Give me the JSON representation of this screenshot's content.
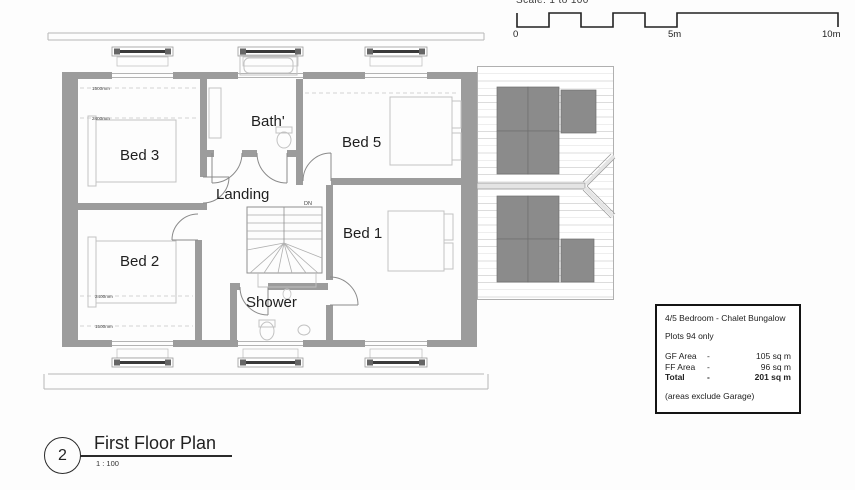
{
  "scale_bar": {
    "caption": "Scale: 1 to 100",
    "ticks": [
      "0",
      "5m",
      "10m"
    ]
  },
  "floor_plan": {
    "rooms": {
      "bed3": "Bed 3",
      "bath": "Bath'",
      "bed5": "Bed 5",
      "landing": "Landing",
      "bed1": "Bed 1",
      "bed2": "Bed 2",
      "shower": "Shower"
    },
    "stair_direction": "DN",
    "dims": {
      "h1500": "1500mm",
      "h2400": "2400mm"
    }
  },
  "info_box": {
    "title": "4/5 Bedroom - Chalet Bungalow",
    "plots": "Plots 94 only",
    "areas": [
      {
        "label": "GF Area",
        "dash": "-",
        "value": "105 sq m"
      },
      {
        "label": "FF Area",
        "dash": "-",
        "value": "96 sq m"
      },
      {
        "label": "Total",
        "dash": "-",
        "value": "201 sq m"
      }
    ],
    "note": "(areas exclude Garage)"
  },
  "title_block": {
    "number": "2",
    "name": "First Floor Plan",
    "scale": "1 : 100"
  },
  "colors": {
    "wall_gray": "#9c9c9c",
    "panel_gray": "#8b8b8b"
  }
}
